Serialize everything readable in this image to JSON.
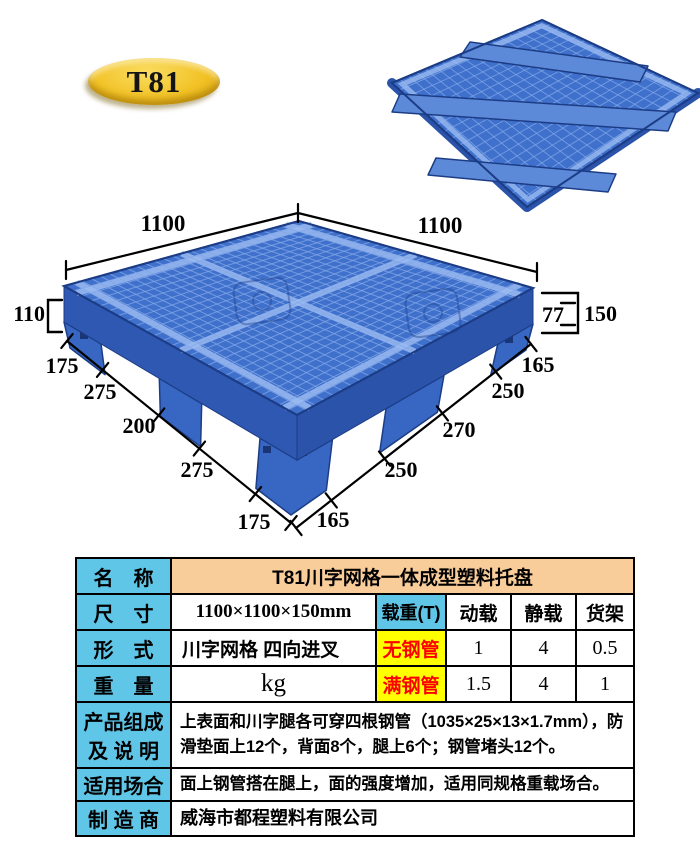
{
  "colors": {
    "pallet_blue": "#3e70cc",
    "pallet_blue_mid": "#2e58b2",
    "pallet_blue_side2": "#2b53aa",
    "pallet_blue_foot": "#3767c2",
    "pallet_outline": "#1c3d86",
    "grid_line": "#85a9e8",
    "grid_beam": "#9bbbf1",
    "slot_dark": "#132a63",
    "table_cyan": "#5fc6e8",
    "table_peach": "#f9cd9a",
    "highlight_yellow": "#ffff00",
    "value_red": "#fe0000",
    "badge_gold": "#f2c226",
    "dim_black": "#000000"
  },
  "badge": {
    "label": "T81"
  },
  "diagram": {
    "dim_top_left": "1100",
    "dim_top_right": "1100",
    "dim_deck_height": "110",
    "dim_fork_height": "77",
    "dim_total_height": "150",
    "left_edge_segments": [
      "175",
      "275",
      "200",
      "275",
      "175"
    ],
    "right_edge_segments": [
      "165",
      "250",
      "270",
      "250",
      "165"
    ]
  },
  "table": {
    "name_label": "名　称",
    "name_value": "T81川字网格一体成型塑料托盘",
    "size_label": "尺　寸",
    "size_value": "1100×1100×150mm",
    "load_label": "载重(T)",
    "load_col_dynamic": "动载",
    "load_col_static": "静载",
    "load_col_rack": "货架",
    "type_label": "形　式",
    "type_value": "川字网格 四向进叉",
    "row_no_pipe_label": "无钢管",
    "no_pipe_dynamic": "1",
    "no_pipe_static": "4",
    "no_pipe_rack": "0.5",
    "weight_label": "重　量",
    "weight_value": "kg",
    "row_full_pipe_label": "满钢管",
    "full_pipe_dynamic": "1.5",
    "full_pipe_static": "4",
    "full_pipe_rack": "1",
    "composition_label_line1": "产品组成",
    "composition_label_line2": "及 说 明",
    "composition_value": "上表面和川字腿各可穿四根钢管（1035×25×13×1.7mm），防滑垫面上12个，背面8个，腿上6个；钢管堵头12个。",
    "usage_label": "适用场合",
    "usage_value": "面上钢管搭在腿上，面的强度增加，适用同规格重载场合。",
    "manufacturer_label": "制 造 商",
    "manufacturer_value": "威海市都程塑料有限公司"
  }
}
